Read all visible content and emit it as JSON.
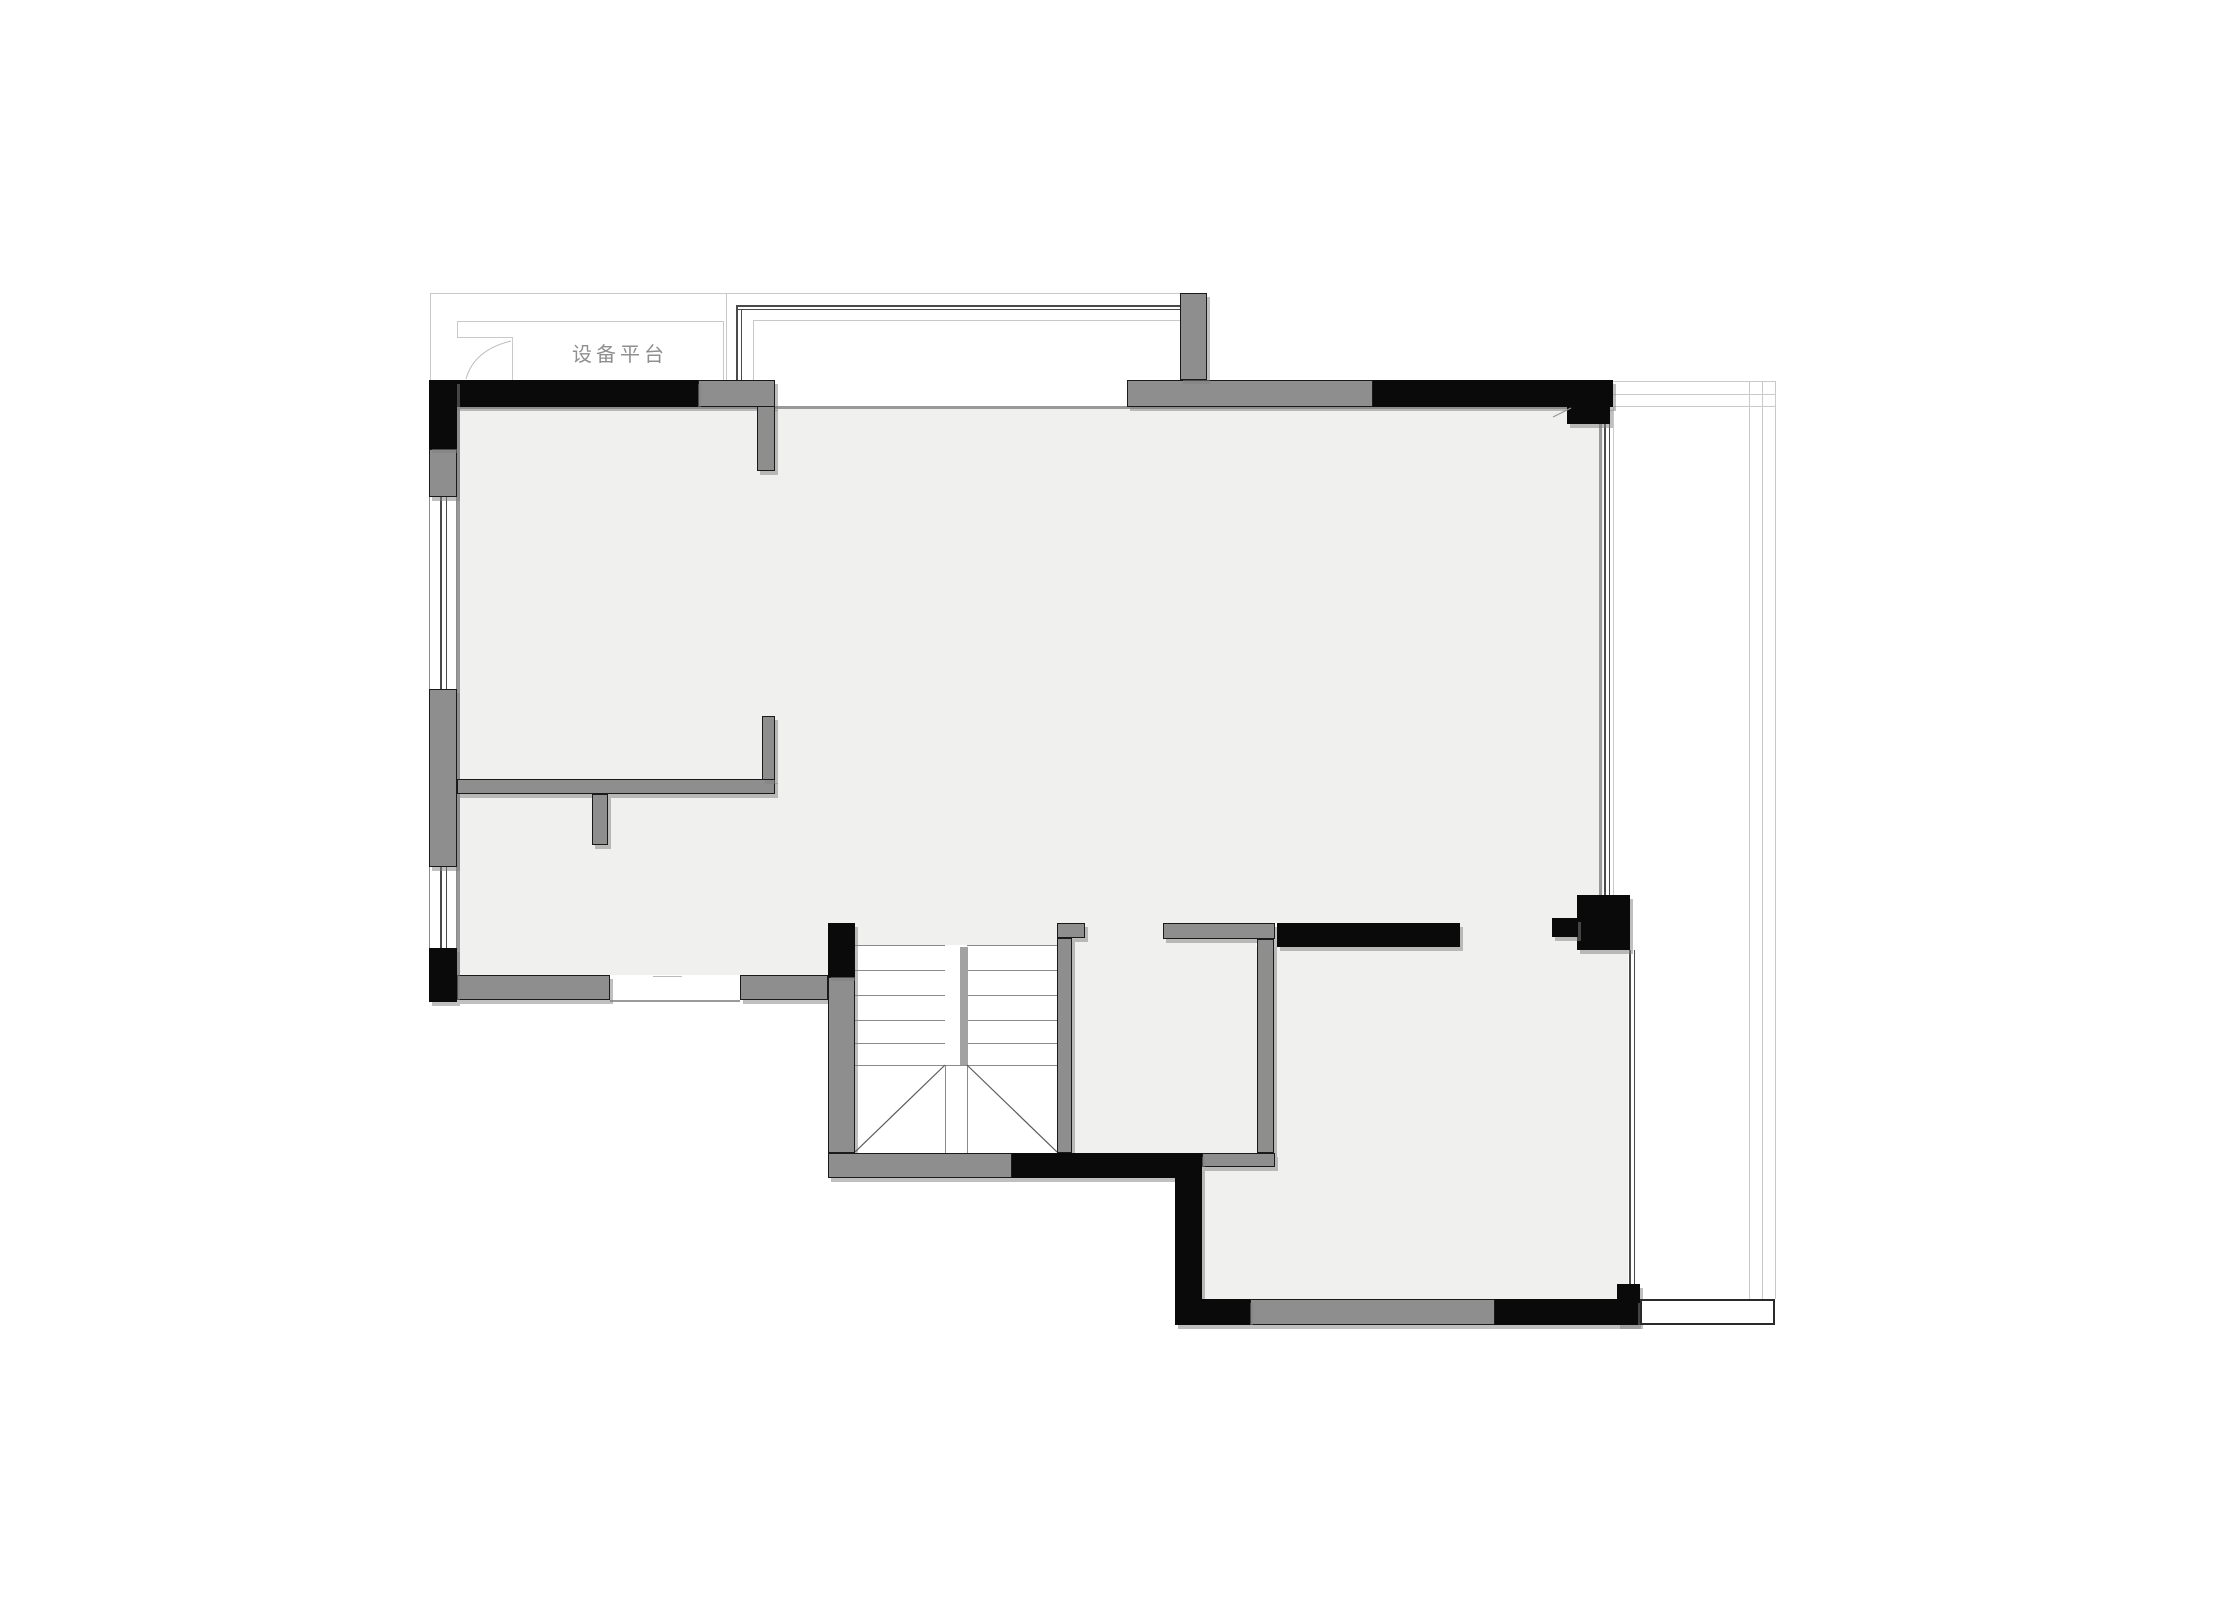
{
  "meta": {
    "width": 2218,
    "height": 1621,
    "background": "#ffffff"
  },
  "palette": {
    "floor": "#f0f0ee",
    "stairwell": "#ffffff",
    "wall_gray": "#8e8e8e",
    "wall_black": "#0a0a0a",
    "wall_outline": "#1a1a1a",
    "line_light": "#c9c9c9",
    "line_mid": "#999999",
    "line_dark": "#4a4a4a",
    "stair_divider": "#a2a2a2",
    "shadow": "rgba(128,128,128,0.5)",
    "label_color": "#8f8f8f"
  },
  "plan": {
    "label": {
      "text": "设备平台",
      "x": 545,
      "y": 338,
      "w": 150,
      "font_size": 20,
      "letter_spacing": 4
    },
    "rects": [
      {
        "n": "main-room-floor",
        "x": 457,
        "y": 407,
        "w": 1146,
        "h": 516,
        "c": "#f0f0ee"
      },
      {
        "n": "living-lower-floor",
        "x": 457,
        "y": 923,
        "w": 371,
        "h": 52,
        "c": "#f0f0ee"
      },
      {
        "n": "stair-top-floor-strip",
        "x": 855,
        "y": 923,
        "w": 202,
        "h": 22,
        "c": "#f0f0ee"
      },
      {
        "n": "small-room-door-floor",
        "x": 1085,
        "y": 923,
        "w": 78,
        "h": 16,
        "c": "#f0f0ee"
      },
      {
        "n": "small-room-floor",
        "x": 1072,
        "y": 939,
        "w": 184,
        "h": 214,
        "c": "#f0f0ee"
      },
      {
        "n": "passage-floor",
        "x": 1460,
        "y": 923,
        "w": 117,
        "h": 24,
        "c": "#f0f0ee"
      },
      {
        "n": "lower-room-floor",
        "x": 1202,
        "y": 947,
        "w": 426,
        "h": 352,
        "c": "#f0f0ee"
      },
      {
        "n": "stairwell-background",
        "x": 855,
        "y": 945,
        "w": 202,
        "h": 208,
        "c": "#ffffff"
      },
      {
        "n": "platform-outer-top-line",
        "x": 430,
        "y": 293,
        "w": 750,
        "h": 1,
        "c": "#c9c9c9"
      },
      {
        "n": "platform-outer-left-line",
        "x": 430,
        "y": 293,
        "w": 1,
        "h": 87,
        "c": "#c9c9c9"
      },
      {
        "n": "platform-outer-right-line",
        "x": 726,
        "y": 294,
        "w": 1,
        "h": 86,
        "c": "#c9c9c9"
      },
      {
        "n": "platform-inner-top-line",
        "x": 457,
        "y": 321,
        "w": 266,
        "h": 1,
        "c": "#c9c9c9"
      },
      {
        "n": "platform-inner-right-line",
        "x": 723,
        "y": 321,
        "w": 1,
        "h": 59,
        "c": "#c9c9c9"
      },
      {
        "n": "platform-inner-left-line",
        "x": 457,
        "y": 321,
        "w": 1,
        "h": 16,
        "c": "#c9c9c9"
      },
      {
        "n": "platform-box-top-line",
        "x": 457,
        "y": 337,
        "w": 55,
        "h": 1,
        "c": "#c9c9c9"
      },
      {
        "n": "platform-box-right-line",
        "x": 512,
        "y": 337,
        "w": 1,
        "h": 43,
        "c": "#c9c9c9"
      },
      {
        "n": "bay-inner-top-line",
        "x": 753,
        "y": 320,
        "w": 427,
        "h": 1,
        "c": "#c9c9c9"
      },
      {
        "n": "bay-inner-left-line",
        "x": 753,
        "y": 320,
        "w": 1,
        "h": 60,
        "c": "#c9c9c9"
      },
      {
        "n": "balcony-top-line-1",
        "x": 1613,
        "y": 381,
        "w": 162,
        "h": 1,
        "c": "#c9c9c9"
      },
      {
        "n": "balcony-top-line-2",
        "x": 1613,
        "y": 394,
        "w": 162,
        "h": 1,
        "c": "#c9c9c9"
      },
      {
        "n": "balcony-top-line-3",
        "x": 1613,
        "y": 406,
        "w": 162,
        "h": 1,
        "c": "#c9c9c9"
      },
      {
        "n": "balcony-right-outer-line",
        "x": 1775,
        "y": 381,
        "w": 1,
        "h": 918,
        "c": "#c9c9c9"
      },
      {
        "n": "balcony-right-mid-line",
        "x": 1762,
        "y": 381,
        "w": 1,
        "h": 918,
        "c": "#c9c9c9"
      },
      {
        "n": "balcony-right-inner-line",
        "x": 1749,
        "y": 381,
        "w": 1,
        "h": 918,
        "c": "#c9c9c9"
      },
      {
        "n": "balcony-left-edge-line",
        "x": 1613,
        "y": 406,
        "w": 1,
        "h": 491,
        "c": "#c9c9c9"
      },
      {
        "n": "bay-window-glass-line-1",
        "x": 736,
        "y": 305,
        "w": 445,
        "h": 2,
        "c": "#4a4a4a"
      },
      {
        "n": "bay-window-glass-line-2",
        "x": 736,
        "y": 309,
        "w": 445,
        "h": 1,
        "c": "#4a4a4a"
      },
      {
        "n": "bay-window-glass-left-1",
        "x": 736,
        "y": 305,
        "w": 2,
        "h": 75,
        "c": "#4a4a4a"
      },
      {
        "n": "bay-window-glass-left-2",
        "x": 741,
        "y": 309,
        "w": 1,
        "h": 71,
        "c": "#4a4a4a"
      },
      {
        "n": "left-window1-outer-line",
        "x": 429,
        "y": 497,
        "w": 1,
        "h": 192,
        "c": "#8a8a8a"
      },
      {
        "n": "left-window1-glass-1",
        "x": 440,
        "y": 497,
        "w": 2,
        "h": 192,
        "c": "#4a4a4a"
      },
      {
        "n": "left-window1-glass-2",
        "x": 446,
        "y": 497,
        "w": 1,
        "h": 192,
        "c": "#4a4a4a"
      },
      {
        "n": "left-window1-inner-line",
        "x": 456,
        "y": 497,
        "w": 1,
        "h": 192,
        "c": "#8a8a8a"
      },
      {
        "n": "left-window2-outer-line",
        "x": 429,
        "y": 867,
        "w": 1,
        "h": 81,
        "c": "#8a8a8a"
      },
      {
        "n": "left-window2-glass-1",
        "x": 440,
        "y": 867,
        "w": 2,
        "h": 81,
        "c": "#4a4a4a"
      },
      {
        "n": "left-window2-glass-2",
        "x": 446,
        "y": 867,
        "w": 1,
        "h": 81,
        "c": "#4a4a4a"
      },
      {
        "n": "left-window2-inner-line",
        "x": 456,
        "y": 867,
        "w": 1,
        "h": 81,
        "c": "#8a8a8a"
      },
      {
        "n": "right-window-upper-glass-1",
        "x": 1604,
        "y": 424,
        "w": 2,
        "h": 473,
        "c": "#4a4a4a"
      },
      {
        "n": "right-window-upper-glass-2",
        "x": 1609,
        "y": 424,
        "w": 1,
        "h": 473,
        "c": "#4a4a4a"
      },
      {
        "n": "right-window-lower-glass-1",
        "x": 1629,
        "y": 950,
        "w": 2,
        "h": 334,
        "c": "#4a4a4a"
      },
      {
        "n": "right-window-lower-glass-2",
        "x": 1634,
        "y": 950,
        "w": 1,
        "h": 334,
        "c": "#4a4a4a"
      },
      {
        "n": "top-wall-inner-face-line",
        "x": 436,
        "y": 406,
        "w": 1167,
        "h": 3,
        "c": "#999999"
      },
      {
        "n": "left-wall-inner-face-line",
        "x": 457,
        "y": 407,
        "w": 3,
        "h": 568,
        "c": "#999999"
      },
      {
        "n": "right-wall-inner-face-line",
        "x": 1599,
        "y": 407,
        "w": 3,
        "h": 490,
        "c": "#999999"
      },
      {
        "n": "door-opening-bottom-line",
        "x": 610,
        "y": 1000,
        "w": 130,
        "h": 2,
        "c": "#9a9a9a"
      },
      {
        "n": "door-leaf-mark",
        "x": 653,
        "y": 976,
        "w": 29,
        "h": 1,
        "c": "#bbbbbb"
      },
      {
        "n": "stair-tread-left-1",
        "x": 855,
        "y": 945,
        "w": 90,
        "h": 1,
        "c": "#8a8a8a"
      },
      {
        "n": "stair-tread-left-2",
        "x": 855,
        "y": 970,
        "w": 90,
        "h": 1,
        "c": "#8a8a8a"
      },
      {
        "n": "stair-tread-left-3",
        "x": 855,
        "y": 995,
        "w": 90,
        "h": 1,
        "c": "#8a8a8a"
      },
      {
        "n": "stair-tread-left-4",
        "x": 855,
        "y": 1020,
        "w": 90,
        "h": 1,
        "c": "#8a8a8a"
      },
      {
        "n": "stair-tread-left-5",
        "x": 855,
        "y": 1043,
        "w": 90,
        "h": 1,
        "c": "#8a8a8a"
      },
      {
        "n": "stair-tread-right-1",
        "x": 967,
        "y": 945,
        "w": 90,
        "h": 1,
        "c": "#8a8a8a"
      },
      {
        "n": "stair-tread-right-2",
        "x": 967,
        "y": 970,
        "w": 90,
        "h": 1,
        "c": "#8a8a8a"
      },
      {
        "n": "stair-tread-right-3",
        "x": 967,
        "y": 995,
        "w": 90,
        "h": 1,
        "c": "#8a8a8a"
      },
      {
        "n": "stair-tread-right-4",
        "x": 967,
        "y": 1020,
        "w": 90,
        "h": 1,
        "c": "#8a8a8a"
      },
      {
        "n": "stair-tread-right-5",
        "x": 967,
        "y": 1043,
        "w": 90,
        "h": 1,
        "c": "#8a8a8a"
      },
      {
        "n": "stair-landing-line",
        "x": 855,
        "y": 1065,
        "w": 202,
        "h": 1,
        "c": "#8a8a8a"
      },
      {
        "n": "stair-center-line-left",
        "x": 945,
        "y": 1065,
        "w": 1,
        "h": 88,
        "c": "#8a8a8a"
      },
      {
        "n": "stair-center-line-right",
        "x": 967,
        "y": 1065,
        "w": 1,
        "h": 88,
        "c": "#8a8a8a"
      },
      {
        "n": "stair-divider-wall",
        "x": 960,
        "y": 947,
        "w": 8,
        "h": 118,
        "c": "#a2a2a2"
      },
      {
        "n": "wall-top-left-segment",
        "x": 698,
        "y": 380,
        "w": 77,
        "h": 27,
        "c": "#8e8e8e",
        "bd": 1,
        "sh": 1
      },
      {
        "n": "wall-top-left-stem",
        "x": 757,
        "y": 406,
        "w": 18,
        "h": 65,
        "c": "#8e8e8e",
        "bd": 1,
        "sh": 1
      },
      {
        "n": "wall-left-gray-upper",
        "x": 429,
        "y": 449,
        "w": 28,
        "h": 48,
        "c": "#8e8e8e",
        "bd": 1,
        "sh": 1
      },
      {
        "n": "wall-left-gray-long",
        "x": 429,
        "y": 689,
        "w": 28,
        "h": 178,
        "c": "#8e8e8e",
        "bd": 1,
        "sh": 1
      },
      {
        "n": "wall-interior-horizontal",
        "x": 457,
        "y": 779,
        "w": 318,
        "h": 15,
        "c": "#8e8e8e",
        "bd": 1,
        "sh": 1
      },
      {
        "n": "wall-interior-vertical",
        "x": 762,
        "y": 716,
        "w": 13,
        "h": 64,
        "c": "#8e8e8e",
        "bd": 1,
        "sh": 1
      },
      {
        "n": "wall-interior-stub",
        "x": 592,
        "y": 794,
        "w": 16,
        "h": 51,
        "c": "#8e8e8e",
        "bd": 1,
        "sh": 1
      },
      {
        "n": "wall-bottom-left-a",
        "x": 457,
        "y": 975,
        "w": 153,
        "h": 25,
        "c": "#8e8e8e",
        "bd": 1,
        "sh": 1
      },
      {
        "n": "wall-bottom-left-b",
        "x": 740,
        "y": 975,
        "w": 88,
        "h": 25,
        "c": "#8e8e8e",
        "bd": 1,
        "sh": 1
      },
      {
        "n": "wall-stair-left",
        "x": 828,
        "y": 977,
        "w": 27,
        "h": 176,
        "c": "#8e8e8e",
        "bd": 1,
        "sh": 1
      },
      {
        "n": "wall-stair-bottom-gray",
        "x": 828,
        "y": 1153,
        "w": 184,
        "h": 25,
        "c": "#8e8e8e",
        "bd": 1,
        "sh": 1
      },
      {
        "n": "wall-stair-right-cap",
        "x": 1057,
        "y": 923,
        "w": 28,
        "h": 15,
        "c": "#8e8e8e",
        "bd": 1,
        "sh": 1
      },
      {
        "n": "wall-stair-right",
        "x": 1057,
        "y": 938,
        "w": 15,
        "h": 215,
        "c": "#8e8e8e",
        "bd": 1,
        "sh": 1
      },
      {
        "n": "wall-small-room-top",
        "x": 1163,
        "y": 923,
        "w": 112,
        "h": 16,
        "c": "#8e8e8e",
        "bd": 1,
        "sh": 1
      },
      {
        "n": "wall-small-room-right",
        "x": 1257,
        "y": 939,
        "w": 17,
        "h": 214,
        "c": "#8e8e8e",
        "bd": 1,
        "sh": 1
      },
      {
        "n": "wall-small-room-bottom",
        "x": 1202,
        "y": 1153,
        "w": 73,
        "h": 14,
        "c": "#8e8e8e",
        "bd": 1,
        "sh": 1
      },
      {
        "n": "wall-bottom-gray-mid",
        "x": 1250,
        "y": 1299,
        "w": 245,
        "h": 26,
        "c": "#8e8e8e",
        "bd": 1,
        "sh": 1
      },
      {
        "n": "wall-top-t-bar",
        "x": 1127,
        "y": 380,
        "w": 246,
        "h": 27,
        "c": "#8e8e8e",
        "bd": 1,
        "sh": 1
      },
      {
        "n": "wall-top-t-stem",
        "x": 1180,
        "y": 293,
        "w": 27,
        "h": 87,
        "c": "#8e8e8e",
        "bd": 1,
        "sh": 1
      },
      {
        "n": "wall-black-top-left",
        "x": 429,
        "y": 380,
        "w": 269,
        "h": 27,
        "c": "#0a0a0a",
        "sh": 1
      },
      {
        "n": "wall-black-left-corner",
        "x": 429,
        "y": 380,
        "w": 28,
        "h": 69,
        "c": "#0a0a0a",
        "sh": 1
      },
      {
        "n": "wall-black-left-bottom-corner",
        "x": 429,
        "y": 948,
        "w": 28,
        "h": 54,
        "c": "#0a0a0a",
        "sh": 1
      },
      {
        "n": "wall-black-stair-column",
        "x": 828,
        "y": 923,
        "w": 27,
        "h": 54,
        "c": "#0a0a0a",
        "sh": 1
      },
      {
        "n": "wall-black-stair-bottom",
        "x": 1012,
        "y": 1153,
        "w": 163,
        "h": 25,
        "c": "#0a0a0a",
        "sh": 1
      },
      {
        "n": "wall-black-pillar",
        "x": 1175,
        "y": 1153,
        "w": 27,
        "h": 172,
        "c": "#0a0a0a",
        "sh": 1
      },
      {
        "n": "wall-black-lower-room-top",
        "x": 1277,
        "y": 923,
        "w": 183,
        "h": 24,
        "c": "#0a0a0a",
        "sh": 1
      },
      {
        "n": "wall-black-top-right",
        "x": 1373,
        "y": 380,
        "w": 240,
        "h": 27,
        "c": "#0a0a0a",
        "sh": 1
      },
      {
        "n": "wall-black-top-right-stub",
        "x": 1567,
        "y": 406,
        "w": 43,
        "h": 18,
        "c": "#0a0a0a",
        "sh": 1
      },
      {
        "n": "wall-black-right-column",
        "x": 1577,
        "y": 895,
        "w": 53,
        "h": 55,
        "c": "#0a0a0a",
        "sh": 1
      },
      {
        "n": "wall-black-right-column-stub",
        "x": 1552,
        "y": 918,
        "w": 26,
        "h": 19,
        "c": "#0a0a0a",
        "sh": 1
      },
      {
        "n": "wall-black-bottom-window-column",
        "x": 1617,
        "y": 1284,
        "w": 23,
        "h": 41,
        "c": "#0a0a0a",
        "sh": 1
      },
      {
        "n": "wall-black-bottom-left",
        "x": 1202,
        "y": 1299,
        "w": 48,
        "h": 26,
        "c": "#0a0a0a",
        "sh": 1
      },
      {
        "n": "wall-black-bottom-right",
        "x": 1495,
        "y": 1299,
        "w": 143,
        "h": 26,
        "c": "#0a0a0a",
        "sh": 1
      },
      {
        "n": "bottom-window-sill-box",
        "x": 1640,
        "y": 1299,
        "w": 135,
        "h": 26,
        "c": "#ffffff",
        "bd2": 1
      }
    ],
    "vectors": {
      "winder_left": {
        "x1": 855,
        "y1": 1152,
        "x2": 945,
        "y2": 1065,
        "c": "#5a5a5a"
      },
      "winder_right": {
        "x1": 967,
        "y1": 1065,
        "x2": 1057,
        "y2": 1152,
        "c": "#5a5a5a"
      },
      "break_mark": {
        "x1": 1553,
        "y1": 417,
        "x2": 1571,
        "y2": 408,
        "c": "#999999"
      },
      "platform_curve": {
        "d": "M466,379 Q474,350 511,341",
        "c": "#bbbbbb"
      }
    }
  }
}
